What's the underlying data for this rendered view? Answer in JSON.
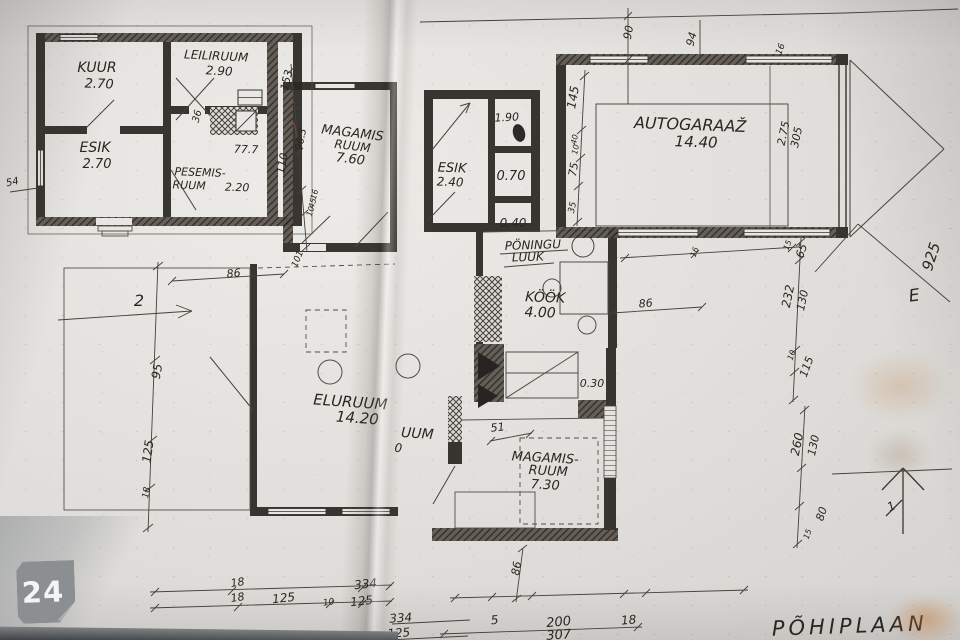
{
  "title": {
    "sheet": "PÕHIPLAAN"
  },
  "watermark": {
    "badge": "24"
  },
  "compass": {
    "letter": "E",
    "arrow_label": "1",
    "direction_2": "2"
  },
  "colors": {
    "paper": "#e3e1dd",
    "ink": "#2a2622",
    "badge_bg": "#8b8f91",
    "badge_text": "#f3f4f4"
  },
  "rooms": {
    "kuur": {
      "name": "KUUR",
      "area": "2.70"
    },
    "leiliruum": {
      "name": "LEILIRUUM",
      "area": "2.90"
    },
    "esik_saun": {
      "name": "ESIK",
      "area": "2.70"
    },
    "pesemisruum": {
      "line1": "PESEMIS-",
      "line2": "RUUM",
      "area": "2.20"
    },
    "magamisruum1": {
      "line1": "MAGAMIS",
      "line2": "RUUM",
      "area": "7.60"
    },
    "esik": {
      "name": "ESIK",
      "area": "2.40"
    },
    "autogaraaz": {
      "name": "AUTOGARAAŽ",
      "area": "14.40"
    },
    "kook": {
      "name": "KÖÖK",
      "area": "4.00"
    },
    "eluruum": {
      "name": "ELURUUM",
      "area": "14.20"
    },
    "magamisruum2": {
      "line1": "MAGAMIS-",
      "line2": "RUUM",
      "area": "7.30"
    },
    "hidden_room": {
      "fragment": "UUM",
      "area_fragment": "0"
    }
  },
  "annotations": {
    "attic_hatch_line1": "PÖNINGU",
    "attic_hatch_line2": "LUUK",
    "area_190": "1.90",
    "area_070": "0.70",
    "area_040": "0.40",
    "area_030": "0.30",
    "area_777": "77.7"
  },
  "dims": {
    "v54": "54",
    "v36": "36",
    "v153": "153",
    "v963": "96.3",
    "v110": "110",
    "v16a": "16",
    "v45": "45",
    "v10a": "10",
    "v101": "101",
    "v86l": "86",
    "v95": "95",
    "v125l": "125",
    "v18l": "18",
    "b18a": "18",
    "b18b": "18",
    "b125a": "125",
    "b10": "10",
    "b125b": "125",
    "b334a": "334",
    "b334b": "334",
    "b125c": "125",
    "v90": "90",
    "v94": "94",
    "v16t": "16",
    "v145": "145",
    "v40": "40",
    "v10c": "10",
    "v75": "75",
    "v35": "35",
    "v275": "2.75",
    "v305": "305",
    "v86r": "86",
    "v16m": "16",
    "v15a": "15",
    "v65": "65",
    "v232": "232",
    "v130a": "130",
    "v10d": "10",
    "v115": "115",
    "v260": "260",
    "v130b": "130",
    "v80": "80",
    "v15b": "15",
    "v925": "925",
    "v51": "51",
    "b86": "86",
    "b5": "5",
    "b200": "200",
    "b18c": "18",
    "b307": "307"
  }
}
